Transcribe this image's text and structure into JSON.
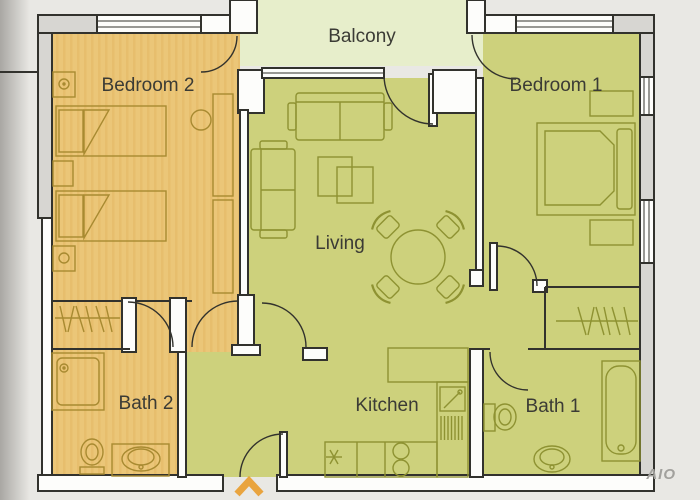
{
  "plan": {
    "type": "apartment-floor-plan",
    "rooms": [
      {
        "id": "balcony",
        "label": "Balcony"
      },
      {
        "id": "bedroom-2",
        "label": "Bedroom 2"
      },
      {
        "id": "bedroom-1",
        "label": "Bedroom 1"
      },
      {
        "id": "living",
        "label": "Living"
      },
      {
        "id": "kitchen",
        "label": "Kitchen"
      },
      {
        "id": "bath-2",
        "label": "Bath 2"
      },
      {
        "id": "bath-1",
        "label": "Bath 1"
      }
    ],
    "watermark": "AIO",
    "palette": {
      "background": "#e9e8e4",
      "tan_room_fill": "#ebc678",
      "olive_room_fill": "#cdd17c",
      "balcony_fill": "#e7eecb",
      "wall_outline": "#32322d",
      "gray_wall_fill": "#d7d6d2",
      "white_wall_fill": "#fdfdfb",
      "furniture_olive": "#8e9232",
      "furniture_tan": "#a88a31",
      "entrance_arrow": "#e9a43e",
      "label_color": "#3b3b35"
    }
  }
}
